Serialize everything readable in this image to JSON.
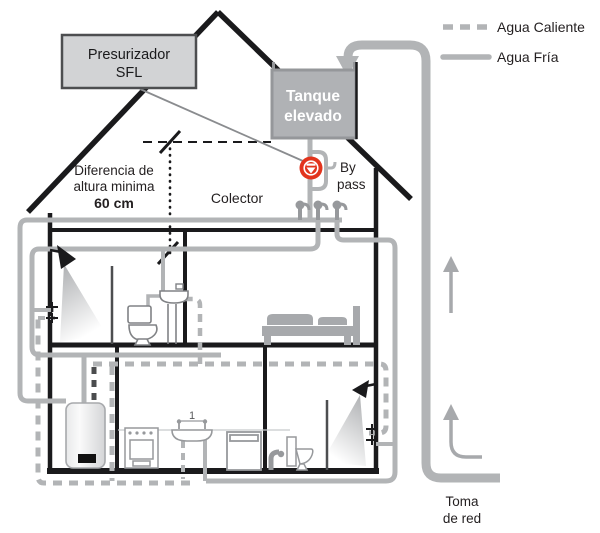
{
  "legend": {
    "hot_label": "Agua Caliente",
    "cold_label": "Agua Fría"
  },
  "pressurizer": {
    "line1": "Presurizador",
    "line2": "SFL"
  },
  "tank": {
    "line1": "Tanque",
    "line2": "elevado"
  },
  "height_note": {
    "line1": "Diferencia de",
    "line2": "altura minima",
    "value": "60 cm"
  },
  "collector_label": "Colector",
  "bypass": {
    "line1": "By",
    "line2": "pass"
  },
  "mains": {
    "line1": "Toma",
    "line2": "de red"
  },
  "kitchen_sink_ref": "1",
  "colors": {
    "pipe_gray": "#b2b4b6",
    "valve_dark_gray": "#97999c",
    "structure_black": "#1a1a1c",
    "tank_fill": "#b0b2b5",
    "tank_border": "#95979a",
    "pressurizer_fill": "#d2d3d5",
    "pressurizer_border": "#4d4e50",
    "valve_red": "#e2341d",
    "fixture_gray": "#a7a9ac",
    "text_black": "#231f20"
  }
}
